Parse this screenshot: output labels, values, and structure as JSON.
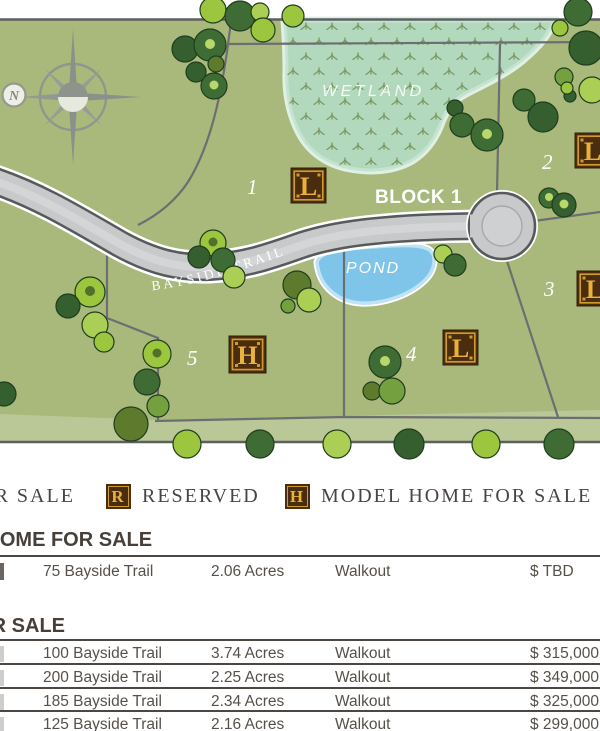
{
  "map": {
    "compass_north_label": "N",
    "labels": {
      "wetland": "WETLAND",
      "pond": "POND",
      "block": "BLOCK 1",
      "road": "BAYSIDE TRAIL"
    },
    "lot_numbers": {
      "lot1": "1",
      "lot2": "2",
      "lot3": "3",
      "lot4": "4",
      "lot5": "5"
    },
    "markers": {
      "lot1": "L",
      "lot2": "L",
      "lot3": "L",
      "lot4": "L",
      "lot5": "H"
    },
    "colors": {
      "grass": "#a9b97c",
      "grass_strip": "#bac898",
      "wetland": "#b2d8bd",
      "wetland_edge": "#dff0e5",
      "pond": "#7fc5e9",
      "pond_edge": "#bfe3f4",
      "road_fill": "#c7c9cb",
      "road_edge": "#58595b",
      "lot_line": "#6d6e71",
      "badge_brown": "#4a2c0f",
      "badge_gold": "#e9b23a",
      "tree_light": "#9dc63f",
      "tree_dark": "#3e6c34"
    }
  },
  "legend": {
    "items": [
      {
        "symbol": "L",
        "label": "FOR SALE"
      },
      {
        "symbol": "R",
        "label": "RESERVED"
      },
      {
        "symbol": "H",
        "label": "MODEL HOME FOR SALE"
      }
    ]
  },
  "model_home_section": {
    "title": "MODEL HOME FOR SALE",
    "rows": [
      {
        "address": "75 Bayside Trail",
        "acreage": "2.06 Acres",
        "basement": "Walkout",
        "price": "$ TBD"
      }
    ]
  },
  "lots_section": {
    "title": "LOTS FOR SALE",
    "rows": [
      {
        "address": "100 Bayside Trail",
        "acreage": "3.74 Acres",
        "basement": "Walkout",
        "price": "$ 315,000"
      },
      {
        "address": "200 Bayside Trail",
        "acreage": "2.25 Acres",
        "basement": "Walkout",
        "price": "$ 349,000"
      },
      {
        "address": "185 Bayside Trail",
        "acreage": "2.34 Acres",
        "basement": "Walkout",
        "price": "$ 325,000"
      },
      {
        "address": "125 Bayside Trail",
        "acreage": "2.16 Acres",
        "basement": "Walkout",
        "price": "$ 299,000"
      }
    ]
  }
}
